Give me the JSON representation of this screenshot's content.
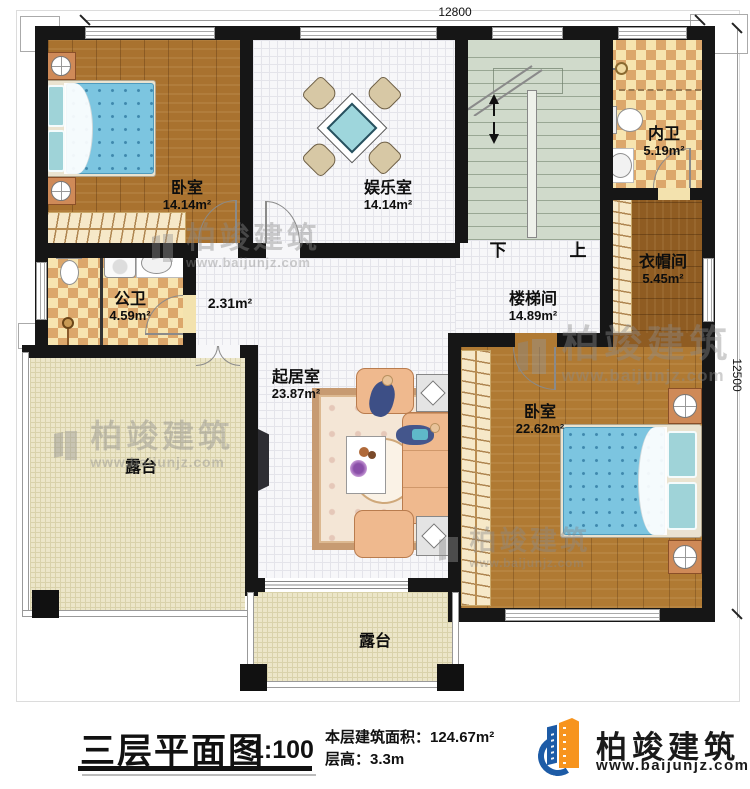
{
  "dimensions": {
    "top": "12800",
    "right": "12500"
  },
  "stairs": {
    "down_label": "下",
    "up_label": "上"
  },
  "rooms": {
    "bedroom1": {
      "name": "卧室",
      "area": "14.14m²"
    },
    "entertainment": {
      "name": "娱乐室",
      "area": "14.14m²"
    },
    "inner_bath": {
      "name": "内卫",
      "area": "5.19m²"
    },
    "cloakroom": {
      "name": "衣帽间",
      "area": "5.45m²"
    },
    "public_bath": {
      "name": "公卫",
      "area": "4.59m²"
    },
    "stairwell": {
      "name": "楼梯间",
      "area": "14.89m²"
    },
    "hallway": {
      "area": "2.31m²"
    },
    "living": {
      "name": "起居室",
      "area": "23.87m²"
    },
    "bedroom2": {
      "name": "卧室",
      "area": "22.62m²"
    },
    "terrace_left": {
      "name": "露台"
    },
    "terrace_bottom": {
      "name": "露台"
    }
  },
  "watermark": {
    "brand": "柏竣建筑",
    "url": "www.baijunjz.com"
  },
  "title_block": {
    "title": "三层平面图",
    "scale": "1:100",
    "area_line": "本层建筑面积：124.67m²",
    "height_line": "层高：3.3m",
    "brand": "柏竣建筑",
    "brand_url": "www.baijunjz.com"
  },
  "colors": {
    "wall": "#161616",
    "logo_blue": "#1d5ba6",
    "logo_orange": "#f7941d",
    "watermark_gray": "#8b8b8b"
  }
}
